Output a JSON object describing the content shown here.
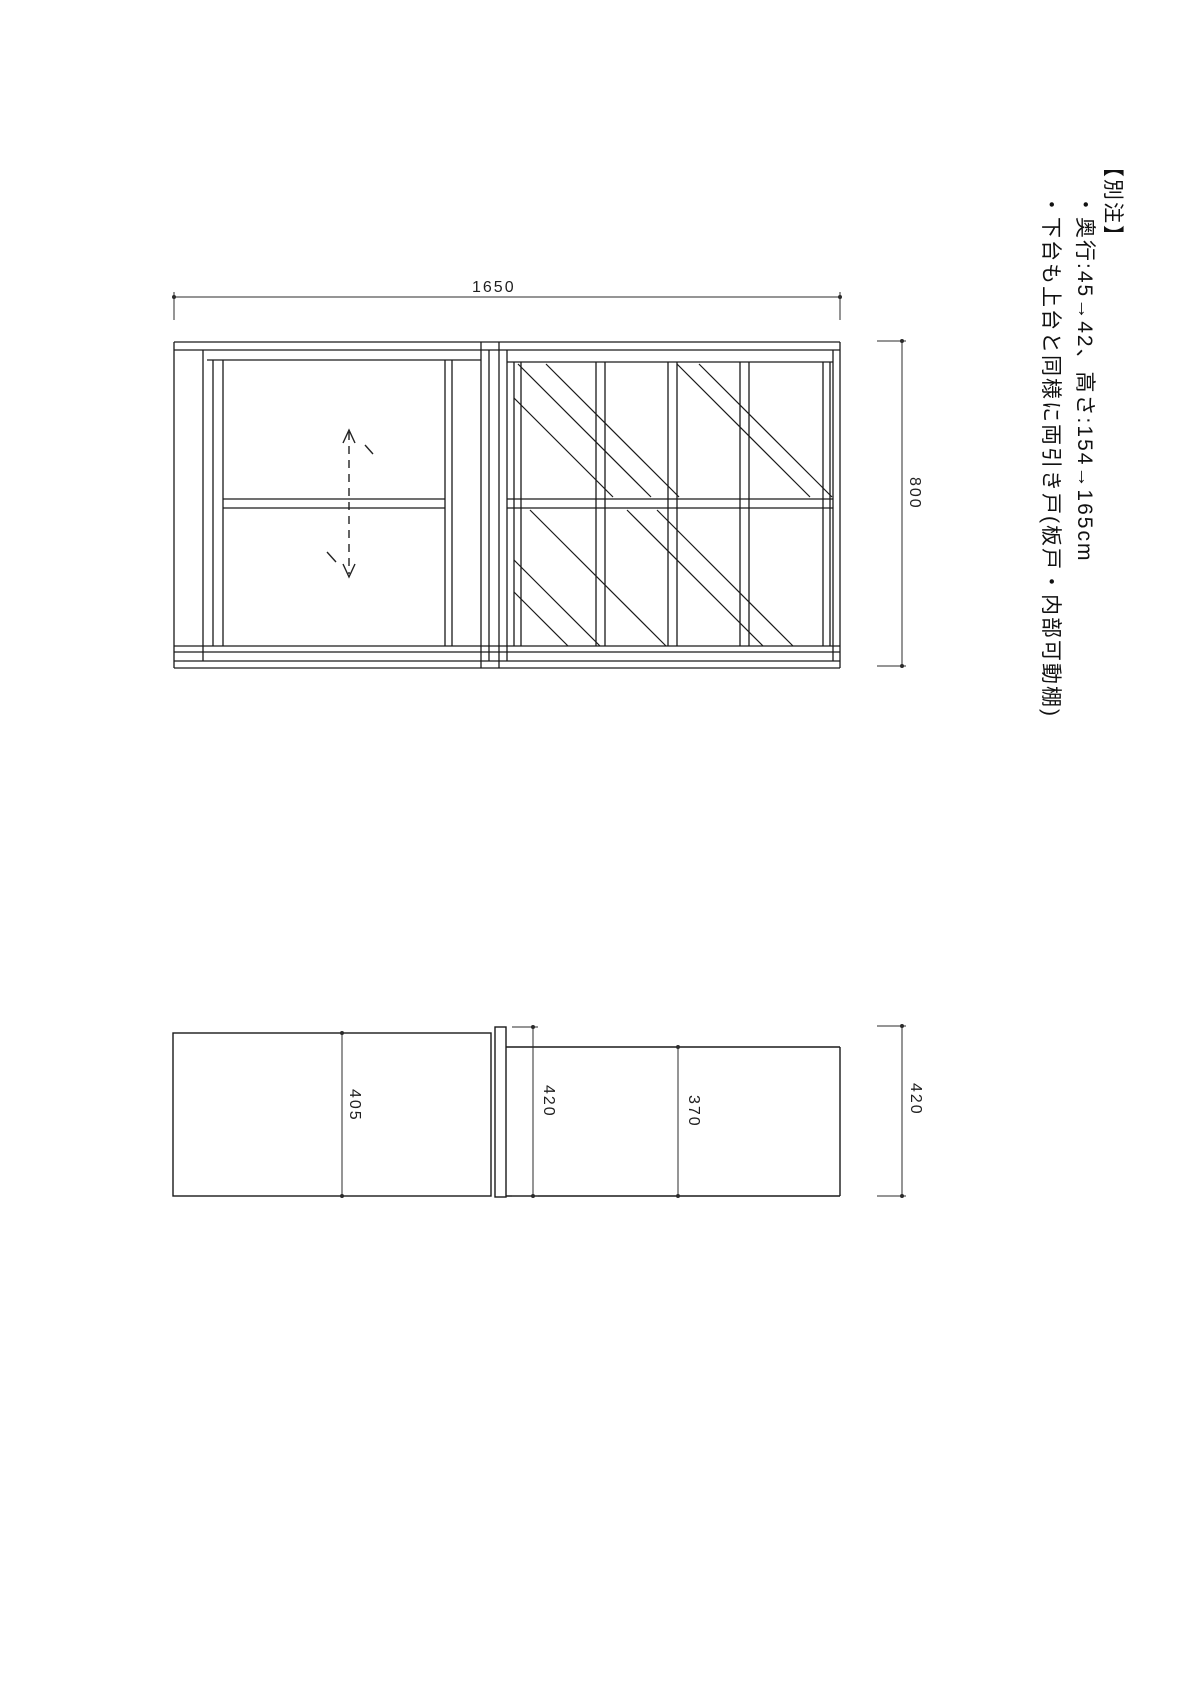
{
  "notes": {
    "title": "【別注】",
    "items": [
      "・奥行:45→42、高さ:154→165cm",
      "・下台も上台と同様に両引き戸(板戸・内部可動棚)"
    ]
  },
  "elevation": {
    "dim_width": "1650",
    "dim_height": "800"
  },
  "plan": {
    "dim_upper_depth": "405",
    "dim_upper_overall_depth": "420",
    "dim_lower_inner_depth": "370",
    "dim_lower_overall_depth": "420"
  },
  "colors": {
    "line": "#1a1a1a",
    "dim_line": "#2b2b2b",
    "text": "#111111",
    "background": "#ffffff"
  }
}
